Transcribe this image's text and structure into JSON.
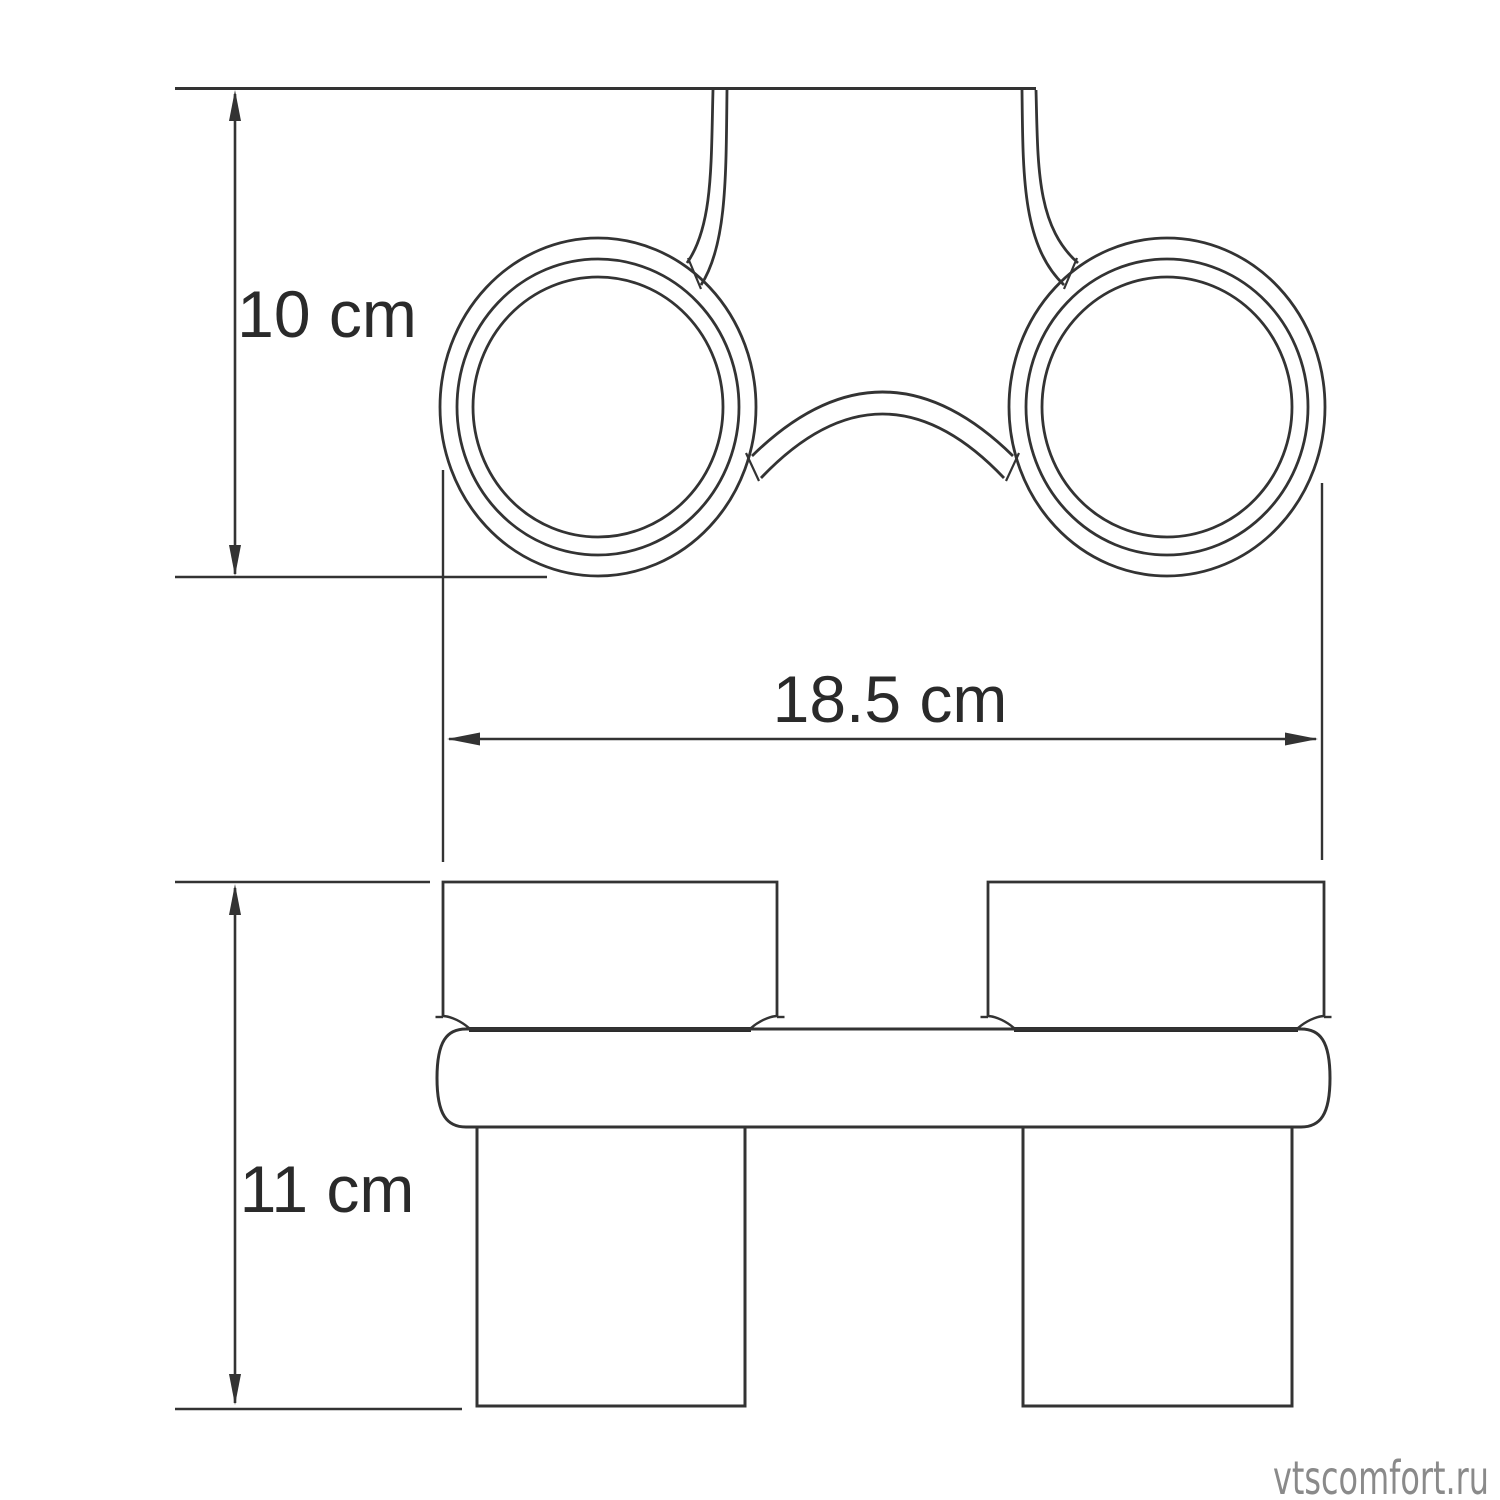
{
  "drawing": {
    "background": "#ffffff",
    "line_color": "#333333",
    "dimensions": {
      "depth_top_view": "10 cm",
      "overall_width": "18.5 cm",
      "front_height": "11 cm"
    },
    "watermark": {
      "text": "vtscomfort.ru",
      "color": "#8a8a8a"
    }
  }
}
